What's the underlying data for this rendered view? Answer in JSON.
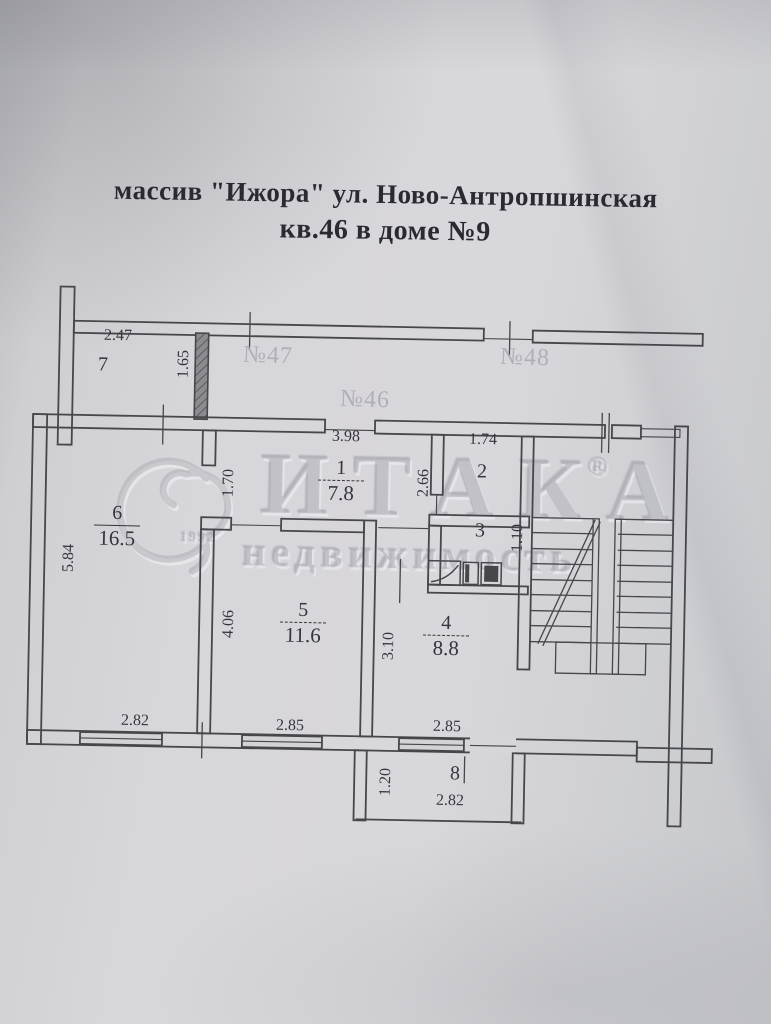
{
  "title": {
    "line1": "массив \"Ижора\" ул. Ново-Антропшинская",
    "line2": "кв.46 в доме №9"
  },
  "watermark": {
    "brand": "ИТАКА",
    "registered": "®",
    "word": "недвижимость",
    "year": "1992"
  },
  "neighbor_labels": {
    "apt47": "№47",
    "apt48": "№48",
    "apt46": "№46"
  },
  "rooms": {
    "room1": {
      "number": "1",
      "area": "7.8"
    },
    "room2": {
      "number": "2"
    },
    "room3": {
      "number": "3"
    },
    "room4": {
      "number": "4",
      "area": "8.8"
    },
    "room5": {
      "number": "5",
      "area": "11.6"
    },
    "room6": {
      "number": "6",
      "area": "16.5"
    },
    "room7": {
      "number": "7"
    },
    "room8": {
      "number": "8"
    }
  },
  "dimensions": {
    "room7_width": "2.47",
    "room7_depth": "1.65",
    "hall_width": "3.98",
    "wc_width": "1.74",
    "hall_left_width": "1.70",
    "wc_depth": "2.66",
    "bath_depth": "1.10",
    "room6_depth": "5.84",
    "room5_depth": "4.06",
    "room4_depth": "3.10",
    "room6_width": "2.82",
    "room5_width": "2.85",
    "room4_width": "2.85",
    "balcony_depth": "1.20",
    "balcony_width": "2.82"
  },
  "colors": {
    "paper": "#d3d3d7",
    "ink": "#46464b",
    "dim": "#35353b",
    "faint": "#b0afb5"
  }
}
